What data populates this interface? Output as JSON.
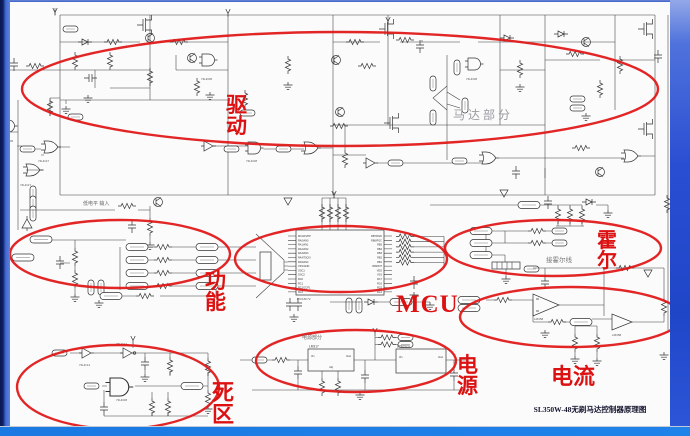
{
  "caption": "SL350W-48无刷马达控制器原理图",
  "regions": {
    "drive": {
      "label": "驱动"
    },
    "function": {
      "label": "功能"
    },
    "deadzone": {
      "label": "死区"
    },
    "mcu": {
      "label": "MCU"
    },
    "power": {
      "label": "电源"
    },
    "current": {
      "label": "电流"
    },
    "hall": {
      "label": "霍尔"
    }
  },
  "notes": {
    "motor_section": "马达部分",
    "hall_wire": "接霍尔线",
    "low_level_input": "低电平 输入",
    "power_section": "电源部分"
  },
  "parts": {
    "mcu_chip": "PIC16F72",
    "reg1": "LM317",
    "reg2": "L7805CV",
    "opamp": "LM358",
    "g08": "74HC08",
    "g27": "74HC27",
    "g14": "74HC14",
    "vin": "Vin",
    "vout": "Vout",
    "adj": "Adj"
  },
  "mcu": {
    "left_pins": [
      "MCLR/VPP",
      "RA0/AN0",
      "RA1/AN1",
      "RA2/AN2",
      "RA3/AN3",
      "RA4/T0CKI",
      "RA5/AN4",
      "VSS/GND",
      "OSC1",
      "OSC2",
      "RC0",
      "RC1",
      "RC2/CCP1",
      "RC3"
    ],
    "right_pins": [
      "RB7/PGD",
      "RB6/PGC",
      "RB5",
      "RB4",
      "RB3",
      "RB2",
      "RB1",
      "RB0/INT",
      "VDD",
      "VSS",
      "RC7",
      "RC6",
      "RC5",
      "RC4"
    ]
  },
  "colors": {
    "annotation_red": "#e01515",
    "slide_border_blue": "#2a4ed2",
    "bottom_bar_blue": "#1c7de6"
  }
}
